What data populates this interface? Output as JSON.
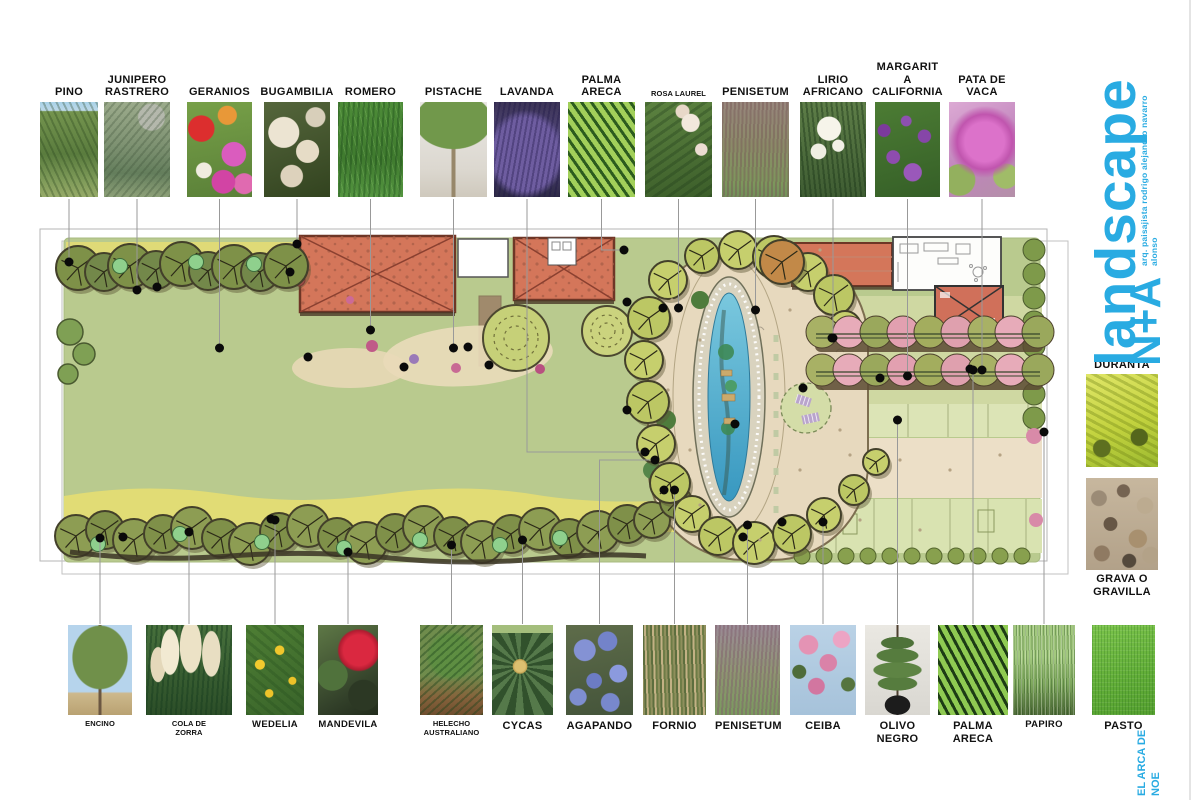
{
  "logo": {
    "word": "landscape",
    "initials": "N+A",
    "credit": "arq. paisajista rodrigo alejandro navarro alonso",
    "footer": "EL ARCA DE\nNOE",
    "brand_color": "#29abe2"
  },
  "colors": {
    "lawn": "#b9ca8e",
    "water": "#4aaac8",
    "roof_red": "#d4765a",
    "gravel": "#e7d9be",
    "hedge_pink": "#e7abb9",
    "yellow_band": "#e3dc74",
    "leader_line": "#999999"
  },
  "plants": {
    "top": [
      {
        "label": "PINO",
        "size": "l",
        "x": 40,
        "w": 58,
        "ty": 262,
        "photo": "repeating-linear-gradient(65deg,rgba(35,62,25,.3) 0 2px,transparent 2px 6px),linear-gradient(180deg,#a9d2e8 0%,#bcd8e8 9%,#74944e 10%,#5a7c3e 55%,#7e9a58 82%,#96aa68 100%)"
      },
      {
        "label": "JUNIPERO\nRASTRERO",
        "size": "l",
        "x": 104,
        "w": 66,
        "ty": 290,
        "photo": "repeating-linear-gradient(-50deg,rgba(55,75,50,.28) 0 2px,transparent 2px 6px),radial-gradient(circle at 72% 16%,#b4b8ac 0 14%,transparent 15%),linear-gradient(180deg,#9cab8c 0%,#7e9272 45%,#647e5c 75%,#8da078 100%)"
      },
      {
        "label": "GERANIOS",
        "size": "l",
        "x": 187,
        "w": 65,
        "ty": 348,
        "photo": "radial-gradient(circle at 22% 28%,#dc2e2e 0 15%,transparent 16%),radial-gradient(circle at 62% 14%,#e89838 0 10%,transparent 11%),radial-gradient(circle at 72% 55%,#da5cbe 0 17%,transparent 18%),radial-gradient(circle at 26% 72%,#f0ece0 0 9%,transparent 10%),radial-gradient(circle at 56% 84%,#d244a4 0 13%,transparent 14%),radial-gradient(circle at 88% 86%,#e06ab0 0 10%,transparent 11%),linear-gradient(170deg,#77a048 0%,#5a8038 100%)"
      },
      {
        "label": "BUGAMBILIA",
        "size": "l",
        "x": 264,
        "w": 66,
        "ty": 244,
        "photo": "radial-gradient(circle at 30% 32%,#ece4d2 0 19%,transparent 20%),radial-gradient(circle at 66% 52%,#e6dcc6 0 17%,transparent 18%),radial-gradient(circle at 42% 78%,#ddd2bc 0 13%,transparent 14%),radial-gradient(circle at 78% 16%,#d8cfba 0 10%,transparent 11%),linear-gradient(160deg,#55663c 0%,#32431f 100%)"
      },
      {
        "label": "ROMERO",
        "size": "l",
        "x": 338,
        "w": 65,
        "ty": 330,
        "photo": "repeating-linear-gradient(93deg,rgba(22,66,22,.35) 0 2px,transparent 2px 5px),repeating-linear-gradient(75deg,rgba(150,200,120,.25) 0 1px,transparent 1px 6px),linear-gradient(180deg,#4d8c38 0%,#3f7a2e 60%,#549540 100%)"
      },
      {
        "label": "PISTACHE",
        "size": "l",
        "x": 420,
        "w": 67,
        "ty": 348,
        "photo": "radial-gradient(ellipse 58% 30% at 50% 20%,#71984b 0 97%,transparent 100%),linear-gradient(90deg,transparent 0 47%,#97876a 47% 53%,transparent 53% 100%),linear-gradient(180deg,#e9e7e3 0%,#dcd8d0 70%,#cfc9bd 100%)"
      },
      {
        "label": "LAVANDA",
        "size": "l",
        "x": 494,
        "w": 66,
        "ty": 452,
        "ex": 645,
        "photo": "repeating-linear-gradient(100deg,rgba(30,22,70,.35) 0 2px,transparent 2px 5px),radial-gradient(ellipse 70% 55% at 48% 55%,#6e5da0 0 70%,transparent 85%),linear-gradient(180deg,#3c3456 0%,#554a80 45%,#2e2a46 100%)"
      },
      {
        "label": "PALMA\nARECA",
        "size": "l",
        "x": 568,
        "w": 67,
        "ty": 250,
        "ex": 624,
        "photo": "repeating-linear-gradient(55deg,#2c5c1e 0 3px,#a2d05a 3px 8px),linear-gradient(150deg,#8cc450 0%,#569434 100%)"
      },
      {
        "label": "ROSA LAUREL",
        "size": "s",
        "x": 645,
        "w": 67,
        "ty": 308,
        "photo": "radial-gradient(circle at 68% 22%,#f2e8dc 0 10%,transparent 11%),radial-gradient(circle at 84% 50%,#ecdcd2 0 8%,transparent 9%),radial-gradient(circle at 56% 10%,#e8d8c8 0 7%,transparent 8%),repeating-linear-gradient(-35deg,rgba(28,56,24,.3) 0 3px,transparent 3px 8px),linear-gradient(170deg,#5c8240 0%,#3c5e2a 100%)"
      },
      {
        "label": "PENISETUM",
        "size": "l",
        "x": 722,
        "w": 67,
        "ty": 310,
        "photo": "repeating-linear-gradient(92deg,rgba(118,88,86,.45) 0 2px,transparent 2px 4px),linear-gradient(180deg,#97867c 0%,#8b8a68 45%,#7d975c 85%,#72905a 100%)"
      },
      {
        "label": "LIRIO\nAFRICANO",
        "size": "l",
        "x": 800,
        "w": 66,
        "ty": 338,
        "photo": "radial-gradient(circle at 44% 28%,#f6f4ea 0 15%,transparent 16%),radial-gradient(circle at 28% 52%,#efeee2 0 11%,transparent 12%),radial-gradient(circle at 58% 46%,#f2f0e6 0 9%,transparent 10%),repeating-linear-gradient(84deg,rgba(22,48,20,.4) 0 2px,transparent 2px 5px),linear-gradient(180deg,#5e7e48 0%,#3e5c32 100%)"
      },
      {
        "label": "MARGARIT A\nCALIFORNIA",
        "size": "l",
        "x": 875,
        "w": 65,
        "ty": 376,
        "photo": "radial-gradient(circle at 28% 58%,#8e4cae 0 9%,transparent 10%),radial-gradient(circle at 58% 74%,#9a58ba 0 11%,transparent 12%),radial-gradient(circle at 76% 36%,#8646a8 0 8%,transparent 9%),radial-gradient(circle at 14% 30%,#7c3a9c 0 7%,transparent 8%),radial-gradient(circle at 48% 20%,#8e50b0 0 6%,transparent 7%),linear-gradient(165deg,#4c7c34 0%,#355f27 100%)"
      },
      {
        "label": "PATA DE\nVACA",
        "size": "l",
        "x": 949,
        "w": 66,
        "ty": 370,
        "photo": "radial-gradient(circle at 54% 42%,#dc72ca 0 30%,#c055ae 42%,transparent 55%),radial-gradient(circle at 16% 82%,#93b05e 0 16%,transparent 17%),radial-gradient(circle at 86% 78%,#a0bc68 0 13%,transparent 14%),linear-gradient(150deg,#dcaad4 0%,#c084bc 55%,#b490a8 100%)"
      }
    ],
    "bottom": [
      {
        "label": "ENCINO",
        "size": "s",
        "x": 68,
        "w": 64,
        "ty": 538,
        "photo": "radial-gradient(ellipse 44% 36% at 50% 36%,#70904a 0 96%,transparent 100%),linear-gradient(90deg,transparent 0 47.5%,#6b5742 47.5% 52.5%,transparent 52.5% 100%),linear-gradient(180deg,#b6d4ec 0% 74%,#cdb88c 76%,#b9a272 100%)"
      },
      {
        "label": "COLA DE\nZORRA",
        "size": "s",
        "x": 146,
        "w": 86,
        "ty": 532,
        "photo": "radial-gradient(ellipse 11% 26% at 28% 30%,#f2ead2 0 95%,transparent 100%),radial-gradient(ellipse 13% 30% at 52% 24%,#ece2c6 0 95%,transparent 100%),radial-gradient(ellipse 11% 26% at 76% 32%,#e8dec2 0 95%,transparent 100%),radial-gradient(ellipse 9% 20% at 14% 44%,#e4d8ba 0 95%,transparent 100%),repeating-linear-gradient(94deg,rgba(18,56,28,.4) 0 2px,transparent 2px 5px),linear-gradient(180deg,#47703c 0%,#2c4e28 100%)"
      },
      {
        "label": "WEDELIA",
        "size": "m",
        "x": 246,
        "w": 58,
        "ty": 520,
        "photo": "radial-gradient(circle at 24% 44%,#f2ca2e 0 7%,transparent 8%),radial-gradient(circle at 58% 28%,#f0c62c 0 6%,transparent 7%),radial-gradient(circle at 80% 62%,#ecc228 0 5%,transparent 6%),radial-gradient(circle at 40% 76%,#eec42a 0 5%,transparent 6%),repeating-linear-gradient(40deg,rgba(30,70,25,.25) 0 3px,transparent 3px 8px),linear-gradient(150deg,#4e7e34 0%,#39642a 100%)"
      },
      {
        "label": "MANDEVILA",
        "size": "m",
        "x": 318,
        "w": 60,
        "ty": 552,
        "photo": "radial-gradient(circle at 68% 28%,#da2840 0 20%,#b01c30 26%,transparent 28%),radial-gradient(circle at 24% 56%,#50723c 0 22%,transparent 23%),radial-gradient(circle at 76% 78%,#2c3824 0 18%,transparent 19%),linear-gradient(150deg,#5e7846 0%,#33412a 70%,#222c1c 100%)"
      },
      {
        "label": "HELECHO\nAUSTRALIANO",
        "size": "s",
        "x": 420,
        "w": 63,
        "ty": 545,
        "photo": "repeating-linear-gradient(-42deg,rgba(26,66,26,.4) 0 2px,transparent 2px 6px),radial-gradient(ellipse 55% 38% at 50% 34%,#5e8e42 0 60%,transparent 75%),linear-gradient(180deg,#6f8c4c 0% 55%,#86633c 80%,#6f4e2e 100%)"
      },
      {
        "label": "CYCAS",
        "size": "l",
        "x": 492,
        "w": 61,
        "ty": 540,
        "photo": "radial-gradient(circle at 46% 46%,#dcc070 0 9%,#c0a050 12%,transparent 13%),linear-gradient(180deg,#a4be7c 0 9%,transparent 9%),repeating-conic-gradient(from 10deg at 46% 46%,#31512c 0 11deg,#55794a 11deg 22deg)"
      },
      {
        "label": "AGAPANDO",
        "size": "l",
        "x": 566,
        "w": 67,
        "ty": 460,
        "ex": 655,
        "photo": "radial-gradient(circle at 28% 28%,#8492d4 0 13%,transparent 14%),radial-gradient(circle at 62% 18%,#7383ca 0 11%,transparent 12%),radial-gradient(circle at 78% 54%,#8b9ade 0 12%,transparent 13%),radial-gradient(circle at 42% 62%,#6c7cc4 0 11%,transparent 12%),radial-gradient(circle at 18% 80%,#7e8ed0 0 9%,transparent 10%),radial-gradient(circle at 66% 86%,#7888cc 0 10%,transparent 11%),linear-gradient(170deg,#5e6c4a 0%,#44543a 100%)"
      },
      {
        "label": "FORNIO",
        "size": "l",
        "x": 643,
        "w": 63,
        "ty": 490,
        "photo": "repeating-linear-gradient(88deg,#8f8f5c 0 2px,#5d6e3e 2px 4px,#c2b184 4px 6px,#6d7c46 6px 8px),linear-gradient(180deg,#7d7d50 0%,#68763f 100%)"
      },
      {
        "label": "PENISETUM",
        "size": "l",
        "x": 715,
        "w": 65,
        "ty": 525,
        "photo": "repeating-linear-gradient(94deg,rgba(128,96,108,.5) 0 2px,transparent 2px 4px),linear-gradient(180deg,#9b8a96 0%,#8d9670 55%,#7a9a5e 100%)"
      },
      {
        "label": "CEIBA",
        "size": "l",
        "x": 790,
        "w": 66,
        "ty": 522,
        "photo": "radial-gradient(circle at 28% 22%,#e493b4 0 11%,transparent 12%),radial-gradient(circle at 58% 42%,#da82a8 0 13%,transparent 14%),radial-gradient(circle at 78% 16%,#eca4c4 0 9%,transparent 10%),radial-gradient(circle at 40% 68%,#d276a0 0 11%,transparent 12%),radial-gradient(circle at 14% 52%,#4e6c3a 0 9%,transparent 10%),radial-gradient(circle at 88% 66%,#56743e 0 8%,transparent 9%),linear-gradient(180deg,#bad2e6 0%,#a6c2da 100%)"
      },
      {
        "label": "OLIVO\nNEGRO",
        "size": "l",
        "x": 865,
        "w": 65,
        "ty": 420,
        "photo": "radial-gradient(ellipse 20% 11% at 50% 89%,#1c1c1c 0 96%,transparent 100%),radial-gradient(ellipse 26% 7% at 50% 20%,#4e7239 0 95%,transparent 100%),radial-gradient(ellipse 33% 8% at 50% 34%,#567c3e 0 95%,transparent 100%),radial-gradient(ellipse 38% 9% at 50% 50%,#5e8444 0 95%,transparent 100%),radial-gradient(ellipse 31% 8% at 50% 65%,#567c3e 0 95%,transparent 100%),linear-gradient(90deg,transparent 0 48.5%,#4c3e2e 48.5% 51.5%,transparent 51.5% 100%),linear-gradient(180deg,#eae8e2 0%,#d9d7d1 100%)"
      },
      {
        "label": "PALMA\nARECA",
        "size": "l",
        "x": 938,
        "w": 70,
        "ty": 370,
        "photo": "repeating-linear-gradient(62deg,#1d3c15 0 3px,#8fca52 3px 8px),repeating-linear-gradient(-62deg,rgba(20,60,15,.35) 0 2px,transparent 2px 7px),linear-gradient(160deg,#67a83e 0%,#417f26 100%)"
      },
      {
        "label": "PAPIRO",
        "size": "m",
        "x": 1013,
        "w": 62,
        "ty": 432,
        "photo": "repeating-linear-gradient(90deg,rgba(250,255,240,.3) 0 1px,transparent 1px 4px),repeating-linear-gradient(88deg,rgba(35,75,25,.35) 0 1px,transparent 1px 3px),linear-gradient(180deg,#a2c87e 0% 35%,#7fa85e 65%,#4e6a38 100%)"
      },
      {
        "label": "PASTO",
        "size": "l",
        "x": 1092,
        "w": 63,
        "ty": null,
        "photo": "repeating-linear-gradient(90deg,rgba(25,95,18,.22) 0 1px,transparent 1px 3px),repeating-linear-gradient(0deg,rgba(255,255,255,.08) 0 1px,transparent 1px 4px),linear-gradient(165deg,#7cc44c 0%,#62ae38 60%,#55a030 100%)"
      }
    ],
    "right": [
      {
        "label": "DURANTA",
        "size": "l",
        "x": 1086,
        "y": 356,
        "w": 72,
        "h": 93,
        "labelPos": "above",
        "photo": "radial-gradient(circle at 74% 68%,#54661c 0 10%,transparent 11%),radial-gradient(circle at 22% 80%,#5e7020 0 9%,transparent 10%),repeating-linear-gradient(28deg,rgba(110,130,20,.35) 0 3px,transparent 3px 7px),linear-gradient(160deg,#e0e668 0%,#c2d23e 55%,#9cba30 100%)"
      },
      {
        "label": "GRAVA O\nGRAVILLA",
        "size": "l",
        "x": 1086,
        "y": 478,
        "w": 72,
        "h": 92,
        "labelPos": "below",
        "photo": "radial-gradient(circle at 18% 22%,#9b8b76 0 8%,transparent 9%),radial-gradient(circle at 52% 14%,#756452 0 7%,transparent 8%),radial-gradient(circle at 82% 30%,#bcab90 0 9%,transparent 10%),radial-gradient(circle at 34% 50%,#665645 0 10%,transparent 11%),radial-gradient(circle at 72% 66%,#a8906f 0 11%,transparent 12%),radial-gradient(circle at 22% 82%,#8f7a62 0 8%,transparent 9%),radial-gradient(circle at 60% 90%,#54493c 0 7%,transparent 8%),radial-gradient(circle at 90% 84%,#b3a288 0 8%,transparent 9%),linear-gradient(180deg,#c7b79e 0%,#b2a189 100%)"
      }
    ]
  }
}
